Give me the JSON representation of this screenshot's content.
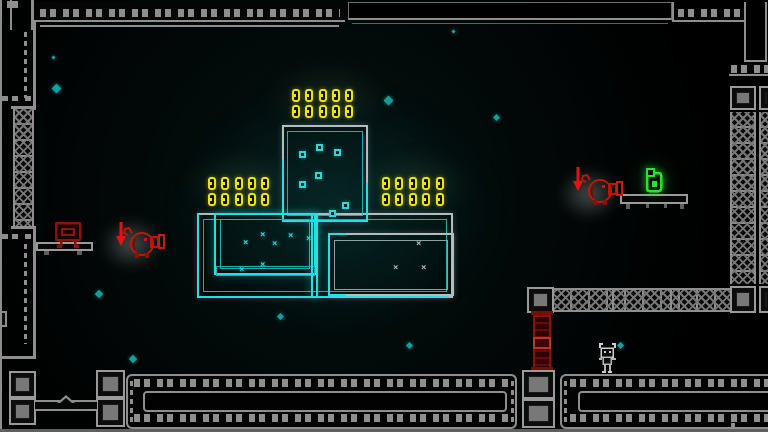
{
  "scene": {
    "name": "neon-platformer-level",
    "width": 768,
    "height": 432,
    "background": "#020808"
  },
  "palette": {
    "wall_gray": "#8e8e8e",
    "block_fill": "#787878",
    "neon_cyan": "#25e0e0",
    "neon_gray": "#b4bdbd",
    "coin_yellow": "#ede400",
    "enemy_red": "#d01808",
    "pillar_red": "#8a1010",
    "pickup_green": "#2ae22a",
    "particle_teal": "#0fa0a0",
    "player_gray": "#cfcfcf"
  },
  "xmark_glyph": "×",
  "coins": {
    "coin_total": 30,
    "groups": [
      {
        "name": "coin-group-top",
        "x": 292,
        "y": 89,
        "cols": 5,
        "rows": 2,
        "dx": 13.3,
        "dy": 16
      },
      {
        "name": "coin-group-left",
        "x": 208,
        "y": 177,
        "cols": 5,
        "rows": 2,
        "dx": 13.3,
        "dy": 16
      },
      {
        "name": "coin-group-right",
        "x": 382,
        "y": 177,
        "cols": 5,
        "rows": 2,
        "dx": 13.4,
        "dy": 16
      }
    ]
  },
  "bits": [
    [
      299,
      151
    ],
    [
      316,
      144
    ],
    [
      334,
      149
    ],
    [
      315,
      172
    ],
    [
      299,
      181
    ],
    [
      342,
      202
    ],
    [
      329,
      210
    ]
  ],
  "xmarks": {
    "cyan": [
      [
        243,
        239
      ],
      [
        260,
        231
      ],
      [
        272,
        240
      ],
      [
        288,
        232
      ],
      [
        306,
        235
      ],
      [
        260,
        261
      ],
      [
        239,
        266
      ]
    ],
    "gray": [
      [
        393,
        264
      ],
      [
        421,
        264
      ],
      [
        416,
        240
      ]
    ]
  },
  "particles": [
    [
      52,
      56,
      3
    ],
    [
      53,
      85,
      7
    ],
    [
      385,
      97,
      7
    ],
    [
      494,
      115,
      5
    ],
    [
      452,
      30,
      3
    ],
    [
      96,
      291,
      6
    ],
    [
      130,
      356,
      6
    ],
    [
      278,
      314,
      5
    ],
    [
      407,
      343,
      5
    ],
    [
      618,
      343,
      5
    ]
  ],
  "enemies": [
    {
      "name": "red-creature-left",
      "x": 122,
      "y": 224,
      "arrow_x": 115,
      "arrow_y": 221
    },
    {
      "name": "red-creature-right",
      "x": 580,
      "y": 171,
      "arrow_x": 572,
      "arrow_y": 166
    }
  ],
  "pickup": {
    "name": "green-key-pickup",
    "x": 645,
    "y": 168
  },
  "player": {
    "name": "player-character",
    "x": 596,
    "y": 341
  },
  "bench": {
    "name": "red-bench",
    "x": 55,
    "y": 221
  },
  "geometry": [
    {
      "n": "glow-center",
      "c": "glow glow-teal",
      "x": 165,
      "y": 80,
      "w": 340,
      "h": 260
    },
    {
      "n": "coin-glow-top",
      "c": "glow glow-coins",
      "x": 262,
      "y": 62,
      "w": 130,
      "h": 70
    },
    {
      "n": "coin-glow-left",
      "c": "glow glow-coins",
      "x": 180,
      "y": 152,
      "w": 120,
      "h": 65
    },
    {
      "n": "coin-glow-right",
      "c": "glow glow-coins",
      "x": 355,
      "y": 152,
      "w": 120,
      "h": 65
    },
    {
      "n": "enemy-glow-left",
      "c": "glow glow-white",
      "x": 100,
      "y": 218,
      "w": 62,
      "h": 52
    },
    {
      "n": "enemy-glow-right",
      "c": "glow glow-white",
      "x": 558,
      "y": 168,
      "w": 62,
      "h": 52
    },
    {
      "n": "pickup-glow",
      "c": "glow glow-green",
      "x": 632,
      "y": 158,
      "w": 44,
      "h": 46
    },
    {
      "n": "top-left-corner-block",
      "c": "wall-line",
      "x": 7,
      "y": 1,
      "w": 11,
      "h": 7
    },
    {
      "n": "top-wall-left",
      "c": "wall-strip",
      "x": 34,
      "y": 2,
      "w": 311,
      "h": 20
    },
    {
      "n": "top-wall-left-dashes",
      "c": "dash-row",
      "x": 40,
      "y": 9,
      "w": 300,
      "h": 8
    },
    {
      "n": "top-wall-left-line2",
      "c": "wall-line",
      "x": 40,
      "y": 25,
      "w": 299,
      "h": 2
    },
    {
      "n": "top-wall-mid-panel",
      "c": "panel",
      "x": 348,
      "y": 2,
      "w": 324,
      "h": 18
    },
    {
      "n": "top-wall-mid-line2",
      "c": "wall-line-dim",
      "x": 352,
      "y": 23,
      "w": 316,
      "h": 1
    },
    {
      "n": "top-right-wall-line-v",
      "c": "wall-line",
      "x": 672,
      "y": 2,
      "w": 2,
      "h": 20
    },
    {
      "n": "top-right-dashes",
      "c": "dash-row",
      "x": 678,
      "y": 9,
      "w": 62,
      "h": 8
    },
    {
      "n": "top-right-line-h",
      "c": "wall-line",
      "x": 672,
      "y": 20,
      "w": 74,
      "h": 2
    },
    {
      "n": "top-right-slot-left",
      "c": "wall-line",
      "x": 744,
      "y": 2,
      "w": 2,
      "h": 60
    },
    {
      "n": "top-right-slot-right",
      "c": "wall-line",
      "x": 765,
      "y": 2,
      "w": 2,
      "h": 60
    },
    {
      "n": "top-right-slot-bottom",
      "c": "wall-line",
      "x": 744,
      "y": 60,
      "w": 23,
      "h": 2
    },
    {
      "n": "top-right-dashes2",
      "c": "dash-row",
      "x": 731,
      "y": 65,
      "w": 37,
      "h": 8
    },
    {
      "n": "top-right-line-h2",
      "c": "wall-line",
      "x": 729,
      "y": 74,
      "w": 39,
      "h": 2
    },
    {
      "n": "left-wall-outer",
      "c": "wall-line",
      "x": 0,
      "y": 0,
      "w": 2,
      "h": 432
    },
    {
      "n": "left-slot-line1",
      "c": "wall-line",
      "x": 10,
      "y": 0,
      "w": 2,
      "h": 30
    },
    {
      "n": "left-slot-line2",
      "c": "wall-line",
      "x": 31,
      "y": 0,
      "w": 3,
      "h": 30
    },
    {
      "n": "left-wall-line-v1",
      "c": "wall-line",
      "x": 33,
      "y": 20,
      "w": 3,
      "h": 90
    },
    {
      "n": "left-wall-dash-v1",
      "c": "dash-col",
      "x": 24,
      "y": 32,
      "w": 3,
      "h": 66
    },
    {
      "n": "left-wall-dash-h1",
      "c": "dash-row",
      "x": 2,
      "y": 96,
      "w": 30,
      "h": 5
    },
    {
      "n": "left-truss-cap-top",
      "c": "wall-line",
      "x": 11,
      "y": 106,
      "w": 25,
      "h": 3
    },
    {
      "n": "left-truss",
      "c": "truss-v",
      "x": 13,
      "y": 109,
      "w": 21,
      "h": 117
    },
    {
      "n": "left-truss-cap-bottom",
      "c": "wall-line",
      "x": 11,
      "y": 226,
      "w": 25,
      "h": 3
    },
    {
      "n": "left-wall-line-v2",
      "c": "wall-line",
      "x": 33,
      "y": 229,
      "w": 3,
      "h": 130
    },
    {
      "n": "left-wall-dash-h2",
      "c": "dash-row",
      "x": 2,
      "y": 234,
      "w": 30,
      "h": 5
    },
    {
      "n": "left-wall-dash-v2",
      "c": "dash-col",
      "x": 24,
      "y": 244,
      "w": 3,
      "h": 100
    },
    {
      "n": "left-wall-notch",
      "c": "wall-box",
      "x": 0,
      "y": 311,
      "w": 7,
      "h": 16
    },
    {
      "n": "left-wall-corner-h",
      "c": "wall-line",
      "x": 0,
      "y": 356,
      "w": 35,
      "h": 3
    },
    {
      "n": "bench-platform",
      "c": "bar-outline",
      "x": 36,
      "y": 242,
      "w": 57,
      "h": 9
    },
    {
      "n": "bench-foot-left",
      "c": "wall-line-dim",
      "x": 44,
      "y": 251,
      "w": 5,
      "h": 4
    },
    {
      "n": "bench-foot-right",
      "c": "wall-line-dim",
      "x": 77,
      "y": 251,
      "w": 5,
      "h": 4
    },
    {
      "n": "room-outer-frame",
      "c": "frame f-gray",
      "x": 197,
      "y": 213,
      "w": 256,
      "h": 85
    },
    {
      "n": "room-outer-frame-cyan",
      "c": "frame f-cyan clip-bl",
      "x": 197,
      "y": 213,
      "w": 256,
      "h": 85
    },
    {
      "n": "room-outer-inner-frame",
      "c": "frame f-cyan-dim",
      "x": 203,
      "y": 219,
      "w": 244,
      "h": 73
    },
    {
      "n": "tower-frame",
      "c": "frame f-gray",
      "x": 282,
      "y": 125,
      "w": 86,
      "h": 97
    },
    {
      "n": "tower-frame-cyan",
      "c": "frame f-cyan clip-diag",
      "x": 282,
      "y": 125,
      "w": 86,
      "h": 97
    },
    {
      "n": "tower-inner-frame",
      "c": "frame f-cyan-dim",
      "x": 287,
      "y": 131,
      "w": 76,
      "h": 85
    },
    {
      "n": "left-room-frame",
      "c": "frame f-cyan",
      "x": 214,
      "y": 213,
      "w": 102,
      "h": 62
    },
    {
      "n": "left-room-inner-frame",
      "c": "frame f-cyan-dim",
      "x": 220,
      "y": 219,
      "w": 90,
      "h": 50
    },
    {
      "n": "left-room-bottom-strip",
      "c": "frame f-cyan-dim",
      "x": 216,
      "y": 266,
      "w": 99,
      "h": 10
    },
    {
      "n": "center-vline",
      "c": "frame f-cyan",
      "x": 311,
      "y": 213,
      "w": 7,
      "h": 85
    },
    {
      "n": "right-room-frame",
      "c": "frame f-gray",
      "x": 328,
      "y": 233,
      "w": 126,
      "h": 63
    },
    {
      "n": "right-room-frame-cyan",
      "c": "frame f-cyan clip-left",
      "x": 328,
      "y": 233,
      "w": 126,
      "h": 63
    },
    {
      "n": "right-room-inner-frame",
      "c": "frame f-gray-dim",
      "x": 334,
      "y": 240,
      "w": 114,
      "h": 50
    },
    {
      "n": "right-wall-block-top-a",
      "c": "block",
      "x": 730,
      "y": 86,
      "w": 26,
      "h": 24
    },
    {
      "n": "right-wall-block-top-b",
      "c": "block",
      "x": 759,
      "y": 86,
      "w": 12,
      "h": 24
    },
    {
      "n": "right-wall-truss-a",
      "c": "truss-v",
      "x": 730,
      "y": 112,
      "w": 26,
      "h": 172
    },
    {
      "n": "right-wall-truss-b",
      "c": "truss-v",
      "x": 759,
      "y": 112,
      "w": 12,
      "h": 172
    },
    {
      "n": "right-wall-block-bottom-a",
      "c": "block",
      "x": 730,
      "y": 286,
      "w": 26,
      "h": 27
    },
    {
      "n": "right-wall-block-bottom-b",
      "c": "block",
      "x": 759,
      "y": 286,
      "w": 12,
      "h": 27
    },
    {
      "n": "platform-block-left",
      "c": "block",
      "x": 527,
      "y": 287,
      "w": 27,
      "h": 26
    },
    {
      "n": "right-platform-truss",
      "c": "truss-h",
      "x": 554,
      "y": 288,
      "w": 176,
      "h": 24
    },
    {
      "n": "truss-divider-1",
      "c": "wall-line",
      "x": 612,
      "y": 290,
      "w": 2,
      "h": 20
    },
    {
      "n": "truss-divider-2",
      "c": "wall-line",
      "x": 670,
      "y": 290,
      "w": 2,
      "h": 20
    },
    {
      "n": "red-pillar-cap-top",
      "c": "pillar-cap",
      "x": 531,
      "y": 311,
      "w": 22,
      "h": 4
    },
    {
      "n": "red-pillar",
      "c": "pillar",
      "x": 533,
      "y": 315,
      "w": 18,
      "h": 54
    },
    {
      "n": "red-pillar-mid",
      "c": "pillar-mid",
      "x": 533,
      "y": 337,
      "w": 18,
      "h": 12
    },
    {
      "n": "red-pillar-cap-bottom",
      "c": "pillar-cap",
      "x": 531,
      "y": 367,
      "w": 22,
      "h": 4
    },
    {
      "n": "pickup-platform",
      "c": "bar-outline",
      "x": 620,
      "y": 194,
      "w": 68,
      "h": 10
    },
    {
      "n": "pickup-platform-foot-1",
      "c": "wall-line-dim",
      "x": 626,
      "y": 204,
      "w": 4,
      "h": 5
    },
    {
      "n": "pickup-platform-foot-2",
      "c": "wall-line-dim",
      "x": 646,
      "y": 204,
      "w": 3,
      "h": 4
    },
    {
      "n": "pickup-platform-foot-3",
      "c": "wall-line-dim",
      "x": 664,
      "y": 204,
      "w": 3,
      "h": 4
    },
    {
      "n": "pickup-platform-foot-4",
      "c": "wall-line-dim",
      "x": 680,
      "y": 204,
      "w": 4,
      "h": 5
    },
    {
      "n": "bottom-left-block-1",
      "c": "block",
      "x": 9,
      "y": 371,
      "w": 27,
      "h": 27
    },
    {
      "n": "bottom-left-block-2",
      "c": "block",
      "x": 9,
      "y": 398,
      "w": 27,
      "h": 27
    },
    {
      "n": "bottom-left-block-3",
      "c": "block",
      "x": 96,
      "y": 370,
      "w": 29,
      "h": 28
    },
    {
      "n": "bottom-left-block-4",
      "c": "block",
      "x": 96,
      "y": 398,
      "w": 29,
      "h": 29
    },
    {
      "n": "seesaw-bar",
      "c": "bar-outline2",
      "x": 35,
      "y": 400,
      "w": 62,
      "h": 11
    },
    {
      "n": "seesaw-triangle",
      "c": "tri",
      "x": 57,
      "y": 395,
      "w": 18,
      "h": 8
    },
    {
      "n": "seesaw-triangle-inner",
      "c": "tri-in",
      "x": 60,
      "y": 398,
      "w": 12,
      "h": 5
    },
    {
      "n": "bottom-mid-platform",
      "c": "wall-box-round",
      "x": 126,
      "y": 374,
      "w": 391,
      "h": 55
    },
    {
      "n": "bottom-mid-dash-top",
      "c": "dash-row",
      "x": 134,
      "y": 379,
      "w": 375,
      "h": 8
    },
    {
      "n": "bottom-mid-dash-bottom",
      "c": "dash-row",
      "x": 134,
      "y": 414,
      "w": 375,
      "h": 8
    },
    {
      "n": "bottom-mid-inner",
      "c": "wall-box-round2",
      "x": 143,
      "y": 391,
      "w": 364,
      "h": 21
    },
    {
      "n": "bottom-mid-cap-left",
      "c": "dash-col",
      "x": 130,
      "y": 381,
      "w": 3,
      "h": 42
    },
    {
      "n": "bottom-mid-cap-right",
      "c": "dash-col",
      "x": 511,
      "y": 381,
      "w": 3,
      "h": 42
    },
    {
      "n": "bottom-center-block-1",
      "c": "block",
      "x": 522,
      "y": 370,
      "w": 33,
      "h": 29
    },
    {
      "n": "bottom-center-block-2",
      "c": "block",
      "x": 522,
      "y": 399,
      "w": 33,
      "h": 29
    },
    {
      "n": "bottom-right-platform",
      "c": "wall-box-round",
      "x": 560,
      "y": 374,
      "w": 215,
      "h": 55
    },
    {
      "n": "bottom-right-dash-top",
      "c": "dash-row",
      "x": 570,
      "y": 379,
      "w": 198,
      "h": 8
    },
    {
      "n": "bottom-right-dash-bottom",
      "c": "dash-row",
      "x": 570,
      "y": 414,
      "w": 198,
      "h": 8
    },
    {
      "n": "bottom-right-inner",
      "c": "wall-box-round2",
      "x": 578,
      "y": 391,
      "w": 197,
      "h": 21
    },
    {
      "n": "bottom-right-cap",
      "c": "dash-col",
      "x": 564,
      "y": 381,
      "w": 3,
      "h": 42
    },
    {
      "n": "bottom-right-divider-dots",
      "c": "dash-col",
      "x": 731,
      "y": 414,
      "w": 4,
      "h": 15
    },
    {
      "n": "bottom-edge-line",
      "c": "wall-line-dim",
      "x": 0,
      "y": 429,
      "w": 768,
      "h": 3
    }
  ]
}
